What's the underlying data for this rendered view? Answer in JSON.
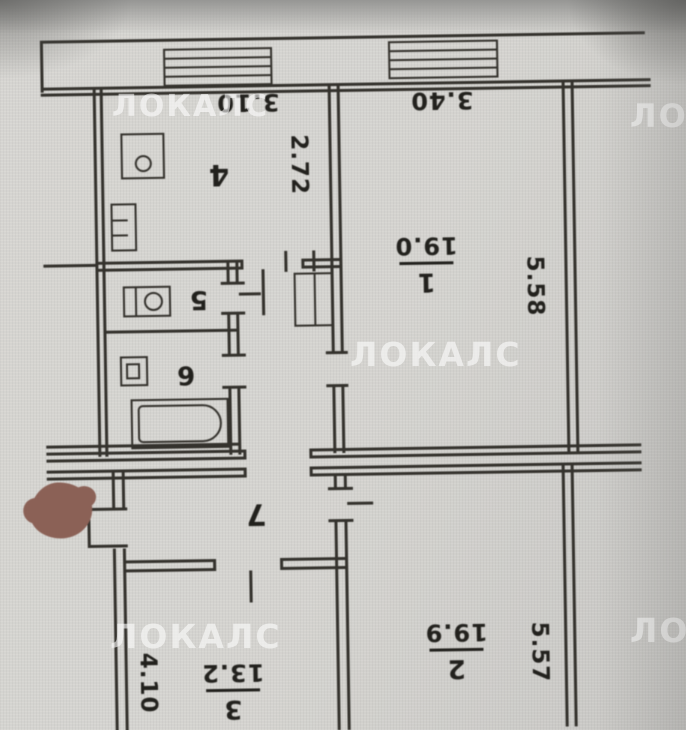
{
  "watermark": {
    "text": "ЛОКАЛС",
    "clipped": "ЛО"
  },
  "rooms": {
    "room1": {
      "number": "1",
      "area": "19.0"
    },
    "room2": {
      "number": "2",
      "area": "19.9"
    },
    "room3": {
      "number": "3",
      "area": "13.2"
    },
    "room4": {
      "number": "4"
    },
    "room5": {
      "number": "5"
    },
    "room6": {
      "number": "6"
    },
    "room7": {
      "number": "7"
    }
  },
  "dimensions": {
    "top_left_width": "3.10",
    "top_right_width": "3.40",
    "kitchen_depth": "2.72",
    "room1_height": "5.58",
    "room2_height": "5.57",
    "room3_height": "4.10"
  },
  "colors": {
    "paper": "#d5d4d0",
    "ink": "#34322d",
    "marker_blob": "#8b6156",
    "watermark": "#ffffff"
  }
}
